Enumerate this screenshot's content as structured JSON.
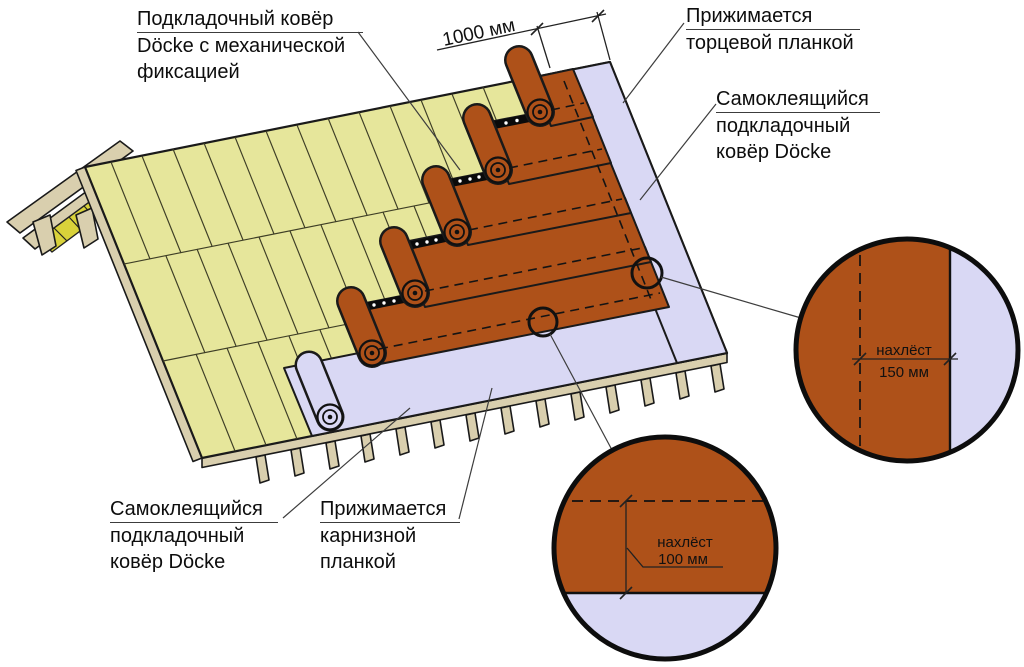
{
  "labels": {
    "underlayment_mech": {
      "line1": "Подкладочный ковёр",
      "line2": "Döcke с механической",
      "line3": "фиксацией"
    },
    "pressed_end_strip": {
      "line1": "Прижимается",
      "line2": "торцевой планкой"
    },
    "self_adhesive_right": {
      "line1": "Самоклеящийся",
      "line2": "подкладочный",
      "line3": "ковёр Döcke"
    },
    "self_adhesive_bottom": {
      "line1": "Самоклеящийся",
      "line2": "подкладочный",
      "line3": "ковёр Döcke"
    },
    "pressed_eaves_strip": {
      "line1": "Прижимается",
      "line2": "карнизной",
      "line3": "планкой"
    }
  },
  "dimensions": {
    "roll_width": "1000 мм",
    "side_overlap_label": "нахлёст",
    "side_overlap_value": "150 мм",
    "bottom_overlap_label": "нахлёст",
    "bottom_overlap_value": "100 мм"
  },
  "colors": {
    "deck_yellow": "#e6e69b",
    "underlayment_orange": "#ae5119",
    "underlayment_lavender": "#d9d8f4",
    "wood_tan": "#d9cfae",
    "sheathing_yellow_bright": "#d9d23a"
  }
}
